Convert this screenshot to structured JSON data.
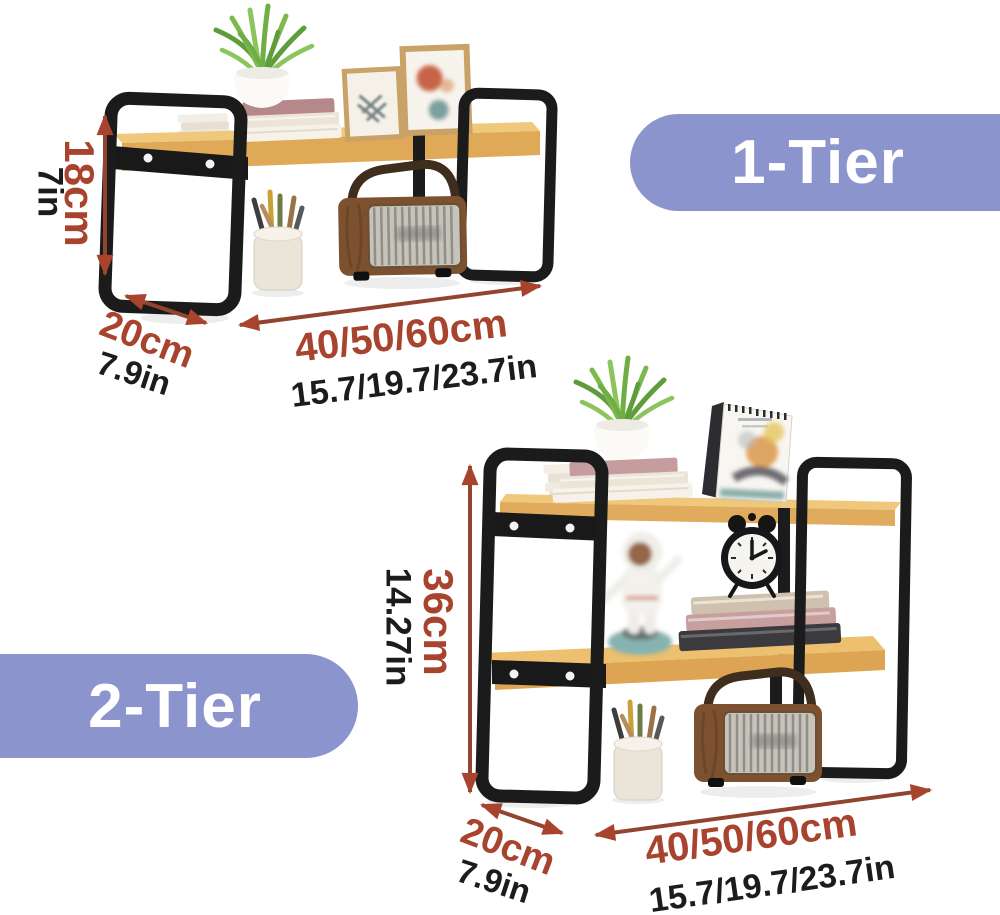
{
  "badges": {
    "tier1_label": "1-Tier",
    "tier2_label": "2-Tier"
  },
  "unit1": {
    "height_cm": "18cm",
    "height_in": "7in",
    "depth_cm": "20cm",
    "depth_in": "7.9in",
    "width_cm": "40/50/60cm",
    "width_in": "15.7/19.7/23.7in"
  },
  "unit2": {
    "height_cm": "36cm",
    "height_in": "14.27in",
    "depth_cm": "20cm",
    "depth_in": "7.9in",
    "width_cm": "40/50/60cm",
    "width_in": "15.7/19.7/23.7in"
  },
  "colors": {
    "dimension_red": "#a8432e",
    "dimension_black": "#1c1c1c",
    "badge_purple": "#8c94ce",
    "badge_text": "#ffffff",
    "wood": "#e0ab5c",
    "metal_black": "#1b1b1b"
  }
}
